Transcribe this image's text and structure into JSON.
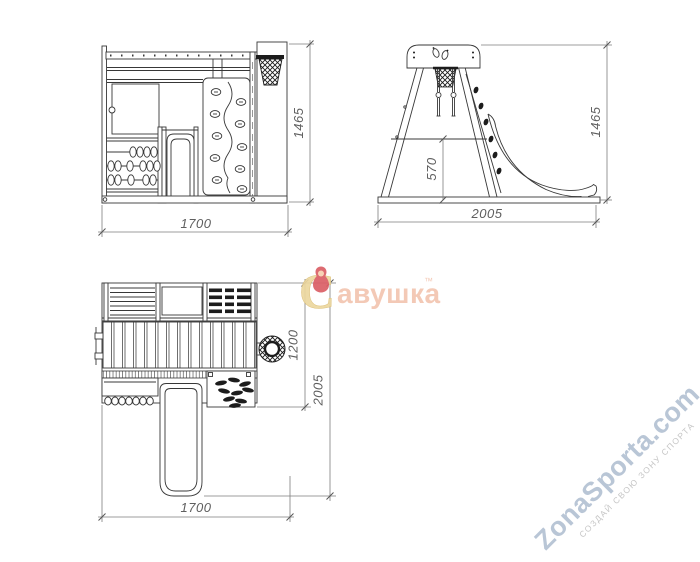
{
  "dimensions": {
    "front": {
      "width": "1700",
      "height": "1465"
    },
    "side": {
      "length": "2005",
      "height": "1465",
      "platform_height": "570"
    },
    "plan": {
      "width": "1700",
      "inner_depth": "1200",
      "total_depth": "2005"
    }
  },
  "watermarks": {
    "brand": {
      "initial": "С",
      "rest": "авушка",
      "trademark": "™"
    },
    "site": {
      "name": "ZonaSporta.com",
      "slogan": "СОЗДАЙ СВОЮ ЗОНУ СПОРТА"
    }
  },
  "colors": {
    "drawing_line": "#383838",
    "dimension_line": "#7d7d7d",
    "dark_fill": "#1c1c1c",
    "brand_gold": "#ecd79f",
    "brand_pink": "#f3c5b0",
    "brand_red": "#db5f66",
    "site_blue": "#b9c6d6",
    "slogan_gray": "#c6c6c6"
  }
}
